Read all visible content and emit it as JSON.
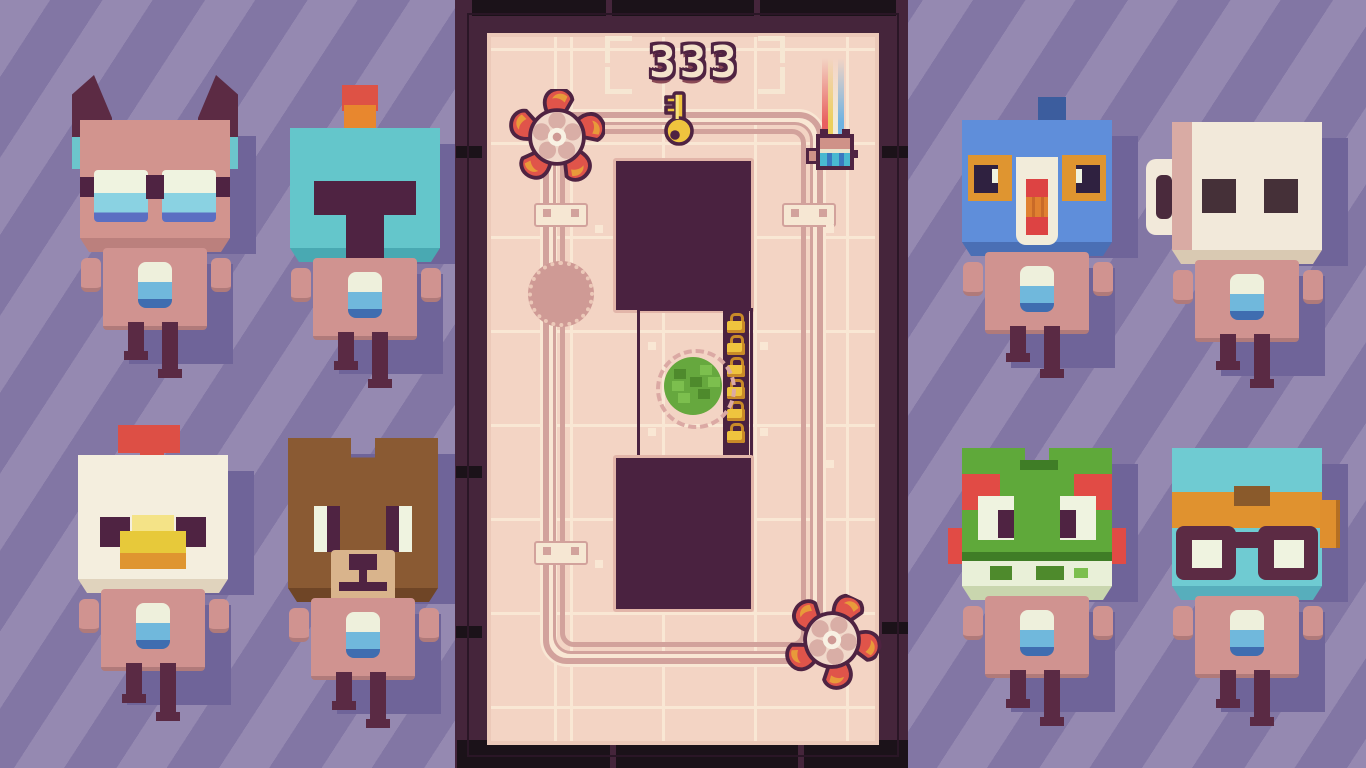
{
  "hud": {
    "score": "333",
    "score_icon": "key-icon"
  },
  "arena": {
    "locks_count": 6,
    "objects": [
      "saw-blade-top-left",
      "saw-blade-bottom-right",
      "bush",
      "player-cat",
      "rainbow-trail",
      "key-icon",
      "score-counter",
      "pit-top",
      "pit-bottom",
      "lock-chain",
      "track-loop",
      "track-circle"
    ]
  },
  "roster": {
    "left": [
      {
        "id": "bat",
        "label": "bat-with-glasses"
      },
      {
        "id": "knight",
        "label": "helmet-knight"
      },
      {
        "id": "chicken",
        "label": "chicken"
      },
      {
        "id": "bear",
        "label": "bear"
      }
    ],
    "right": [
      {
        "id": "pigeon",
        "label": "blue-pigeon"
      },
      {
        "id": "mug",
        "label": "mug-bot"
      },
      {
        "id": "frog",
        "label": "frog"
      },
      {
        "id": "goggles",
        "label": "goggle-scout"
      }
    ]
  },
  "colors": {
    "bg-a": "#9589b1",
    "bg-b": "#8276a4",
    "shadow": "#6f6499",
    "bezel": "#45253b",
    "bezel-dark": "#1b1219",
    "rim": "#ecc9b9",
    "floor": "#f3d4c4",
    "floor-line": "#f9e7d4",
    "track": "#d2a29c",
    "pit": "#4a2240",
    "outline": "#4f2342",
    "gold": "#efc43e",
    "gold-dark": "#c98a28",
    "cream": "#f6e7d3",
    "saw-red": "#e0544a",
    "saw-orange": "#e89a3a",
    "body-pink": "#d09390",
    "leg": "#5a2a44",
    "badge-blue": "#70b8dc"
  }
}
